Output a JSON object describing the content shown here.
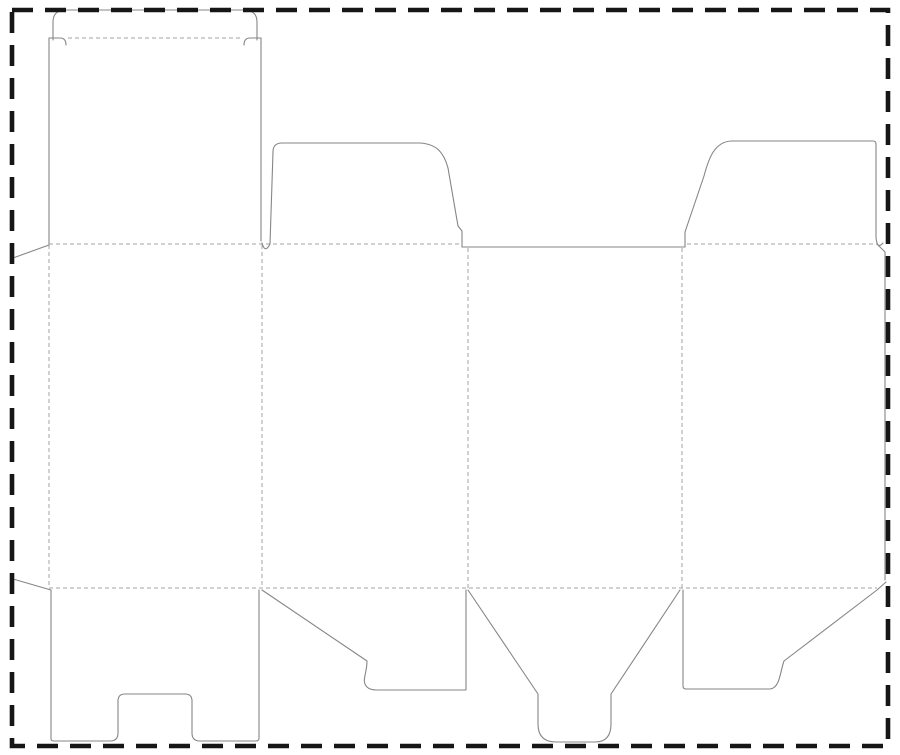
{
  "document": {
    "type": "packaging-dieline-template",
    "description": "Die-cut template for a tuck-top folding carton: four body panels, tuck flap, dust flaps, glue strips, bottom closure flaps"
  },
  "canvas": {
    "width": 900,
    "height": 755,
    "background": "#ffffff"
  },
  "colors": {
    "cut_line": "#868686",
    "fold_line": "#a3a3a3",
    "page_border": "#161616"
  },
  "line_styles": {
    "cut_width": 1.1,
    "fold_width": 1,
    "fold_dash": "4 3",
    "border_width": 4.6,
    "border_dash": "21 12"
  },
  "page_border": {
    "x": 12,
    "y": 10,
    "width": 876,
    "height": 736
  },
  "cut_paths": [
    {
      "name": "tuck-flap-outline",
      "d": "M 53 40 L 53 22 Q 53 10 66 10 L 243 10 Q 257 10 257 22 L 257 40"
    },
    {
      "name": "tuck-lock-slit-left",
      "d": "M 49 38 L 60 38 Q 66 38 66 45"
    },
    {
      "name": "tuck-lock-slit-right",
      "d": "M 261 38 L 250 38 Q 244 38 244 45"
    },
    {
      "name": "panel1-left-cut-edge",
      "d": "M 49 38 L 49 244"
    },
    {
      "name": "panel1-right-cut-edge",
      "d": "M 261 38 L 261 241"
    },
    {
      "name": "glue-strip-left-top-diagonal",
      "d": "M 13 258 L 49 245"
    },
    {
      "name": "glue-strip-left-bottom-diagonal",
      "d": "M 13 579 L 51 590"
    },
    {
      "name": "dust-flap-left",
      "d": "M 262 243 Q 265 254 270 244 L 273 152 Q 273 143 282 143 L 420 143 C 437 144 444 153 448 168 L 458 226 L 462 231 L 462 247"
    },
    {
      "name": "panel3-top-cut",
      "d": "M 462 247 L 685 247"
    },
    {
      "name": "dust-flap-right",
      "d": "M 685 247 L 685 232 L 704 176 C 709 157 715 142 731 141 L 873 141 Q 876 141 876 144 L 876 237 Q 877 250 883 243"
    },
    {
      "name": "glue-strip-right-top-diagonal",
      "d": "M 877 244 L 885 252"
    },
    {
      "name": "glue-strip-right-edge",
      "d": "M 885 252 L 885 580"
    },
    {
      "name": "bottom-flap-panel1-notched",
      "d": "M 51 590 L 51 739 Q 51 741 54 741 L 110 741 Q 118 741 118 733 L 118 701 Q 118 694 125 694 L 185 694 Q 192 694 192 701 L 192 733 Q 192 741 200 741 L 256 741 Q 259 741 259 738 L 259 590"
    },
    {
      "name": "bottom-flap-panel2-hooked",
      "d": "M 262 590 L 367 661 C 367 674 361 681 367 687 Q 370 690 377 690 L 466 690 L 466 590"
    },
    {
      "name": "bottom-flap-panel3-funnel",
      "d": "M 468 590 L 538 694 L 538 724 Q 538 742 556 742 L 595 742 Q 611 742 611 724 L 611 694 L 680 590"
    },
    {
      "name": "bottom-flap-panel4-hooked",
      "d": "M 683 590 L 683 686 Q 683 689 686 689 L 770 689 C 780 688 780 672 784 661 L 877 590 L 886 582"
    }
  ],
  "fold_paths": [
    {
      "name": "tuck-fold-line",
      "d": "M 68 38 L 242 38"
    },
    {
      "name": "top-fold-line-left",
      "d": "M 49 244 L 460 244"
    },
    {
      "name": "top-fold-line-right",
      "d": "M 687 244 L 877 244"
    },
    {
      "name": "bottom-fold-line",
      "d": "M 49 588 L 877 588"
    },
    {
      "name": "fold-glue-strip-left",
      "d": "M 49 245 L 49 588"
    },
    {
      "name": "fold-panel1-panel2",
      "d": "M 262 245 L 262 588"
    },
    {
      "name": "fold-panel2-panel3",
      "d": "M 468 248 L 468 588"
    },
    {
      "name": "fold-panel3-panel4",
      "d": "M 682 248 L 682 588"
    }
  ]
}
